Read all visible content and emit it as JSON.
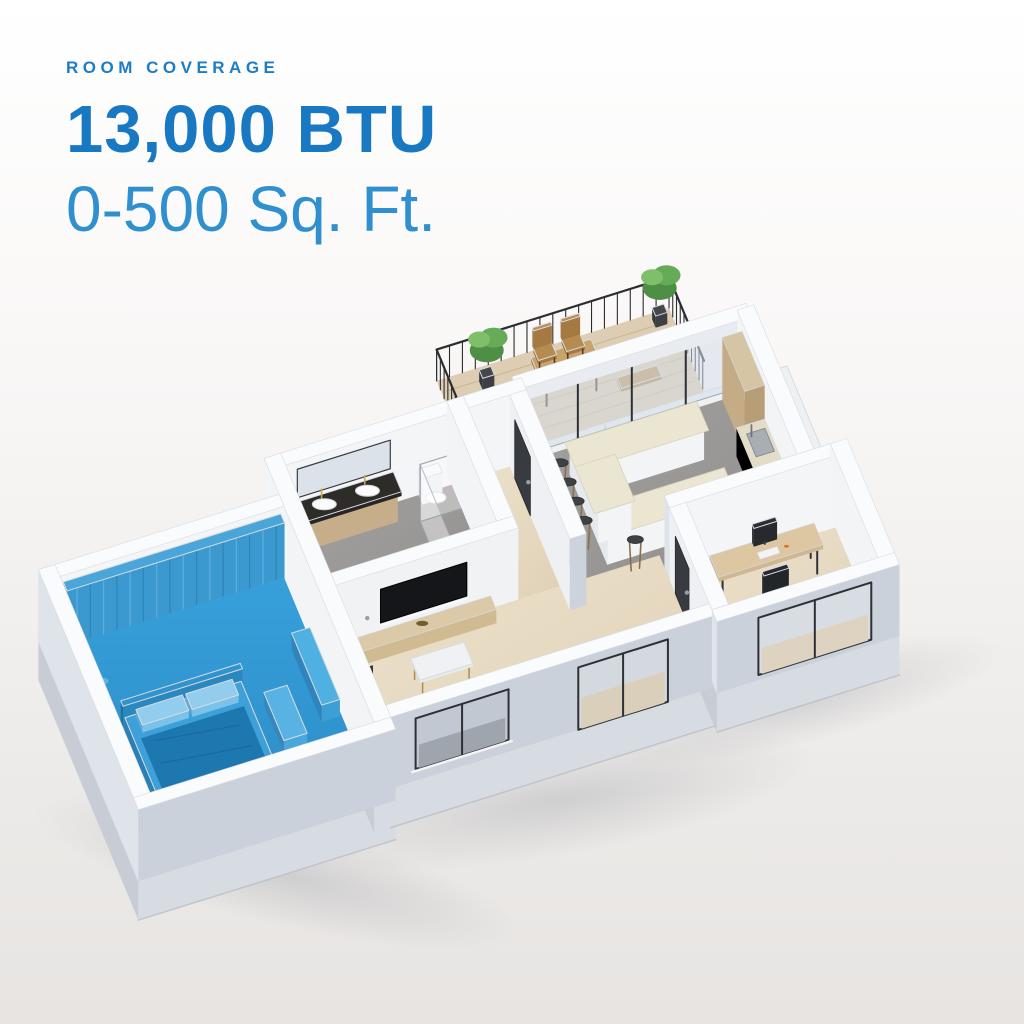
{
  "header": {
    "eyebrow": "ROOM COVERAGE",
    "btu_rating": "13,000 BTU",
    "coverage": "0-500 Sq. Ft."
  },
  "floorplan": {
    "highlighted_room": "bedroom",
    "rooms_visible": [
      "bedroom",
      "bathroom",
      "living room",
      "kitchen-dining",
      "entry hallway",
      "home office",
      "balcony terrace"
    ]
  },
  "colors": {
    "accent_blue": "#1c7dc5",
    "accent_blue_light": "#3090cf",
    "room_highlight_blue": "#2f96d2",
    "background_top": "#ffffff",
    "background_bottom": "#e7e4e2",
    "wall_white": "#fafbfc",
    "wall_shadow": "#cdd3dd"
  }
}
